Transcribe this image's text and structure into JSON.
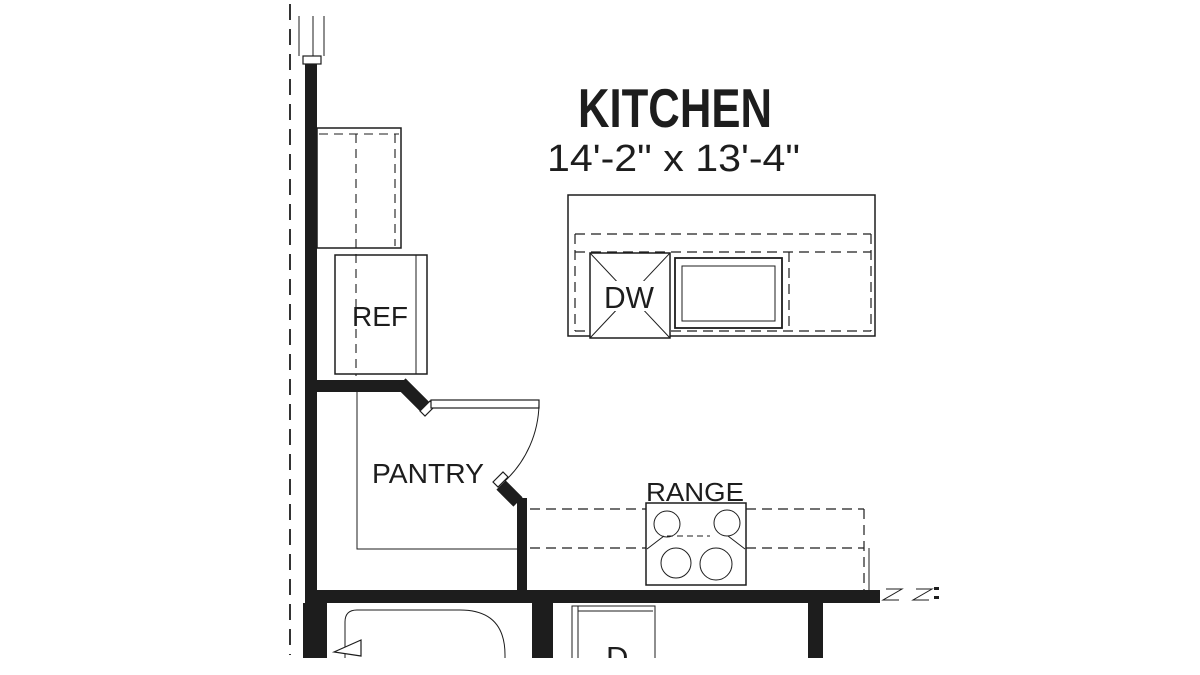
{
  "drawing": {
    "title": "KITCHEN",
    "dimensions": "14'-2\" x 13'-4\"",
    "labels": {
      "refrigerator": "REF",
      "pantry": "PANTRY",
      "range": "RANGE",
      "dishwasher": "DW",
      "dryer": "D"
    },
    "colors": {
      "line": "#1d1d1d",
      "background": "#ffffff"
    }
  }
}
